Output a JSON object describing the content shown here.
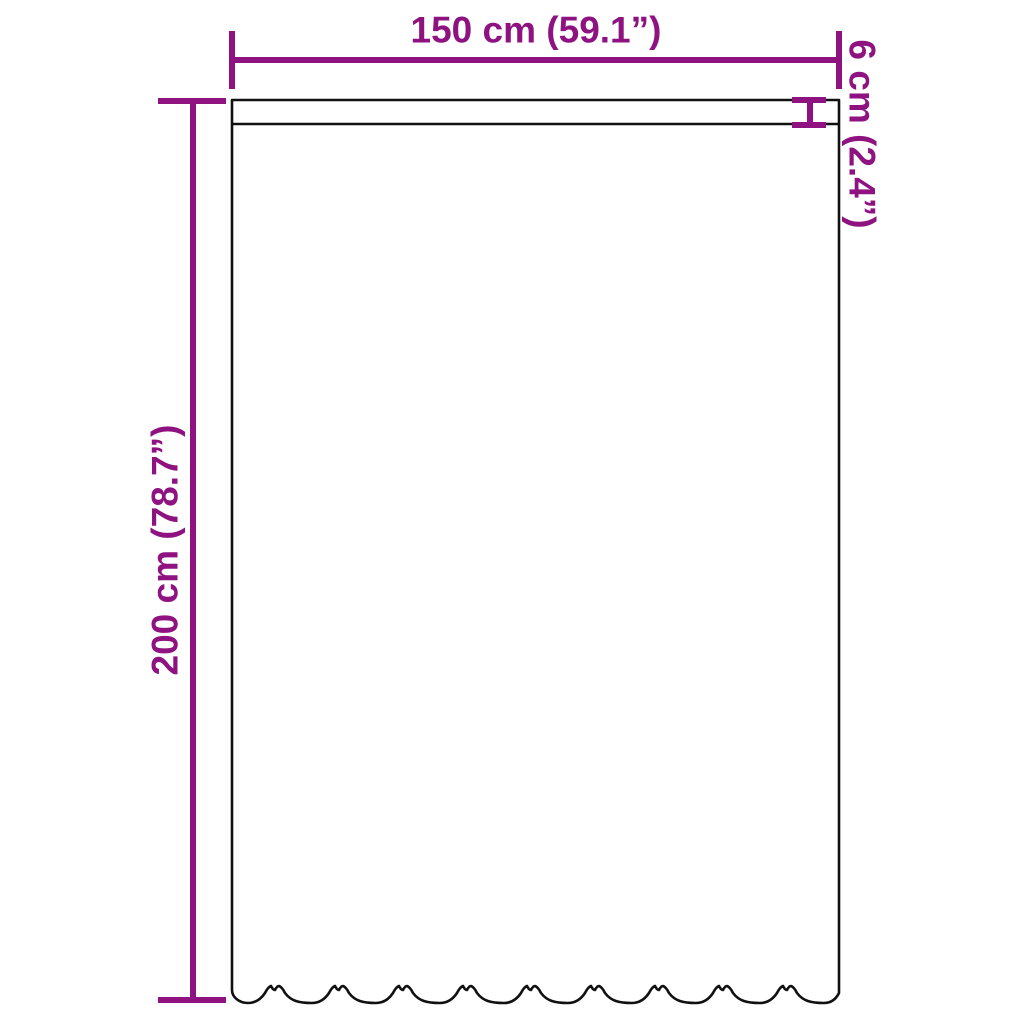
{
  "diagram": {
    "accent_color": "#8e1380",
    "outline_color": "#111111",
    "background_color": "#ffffff",
    "dimensions": {
      "width_label": "150 cm (59.1”)",
      "height_label": "200 cm (78.7”)",
      "pocket_label": "6 cm (2.4”)"
    }
  }
}
